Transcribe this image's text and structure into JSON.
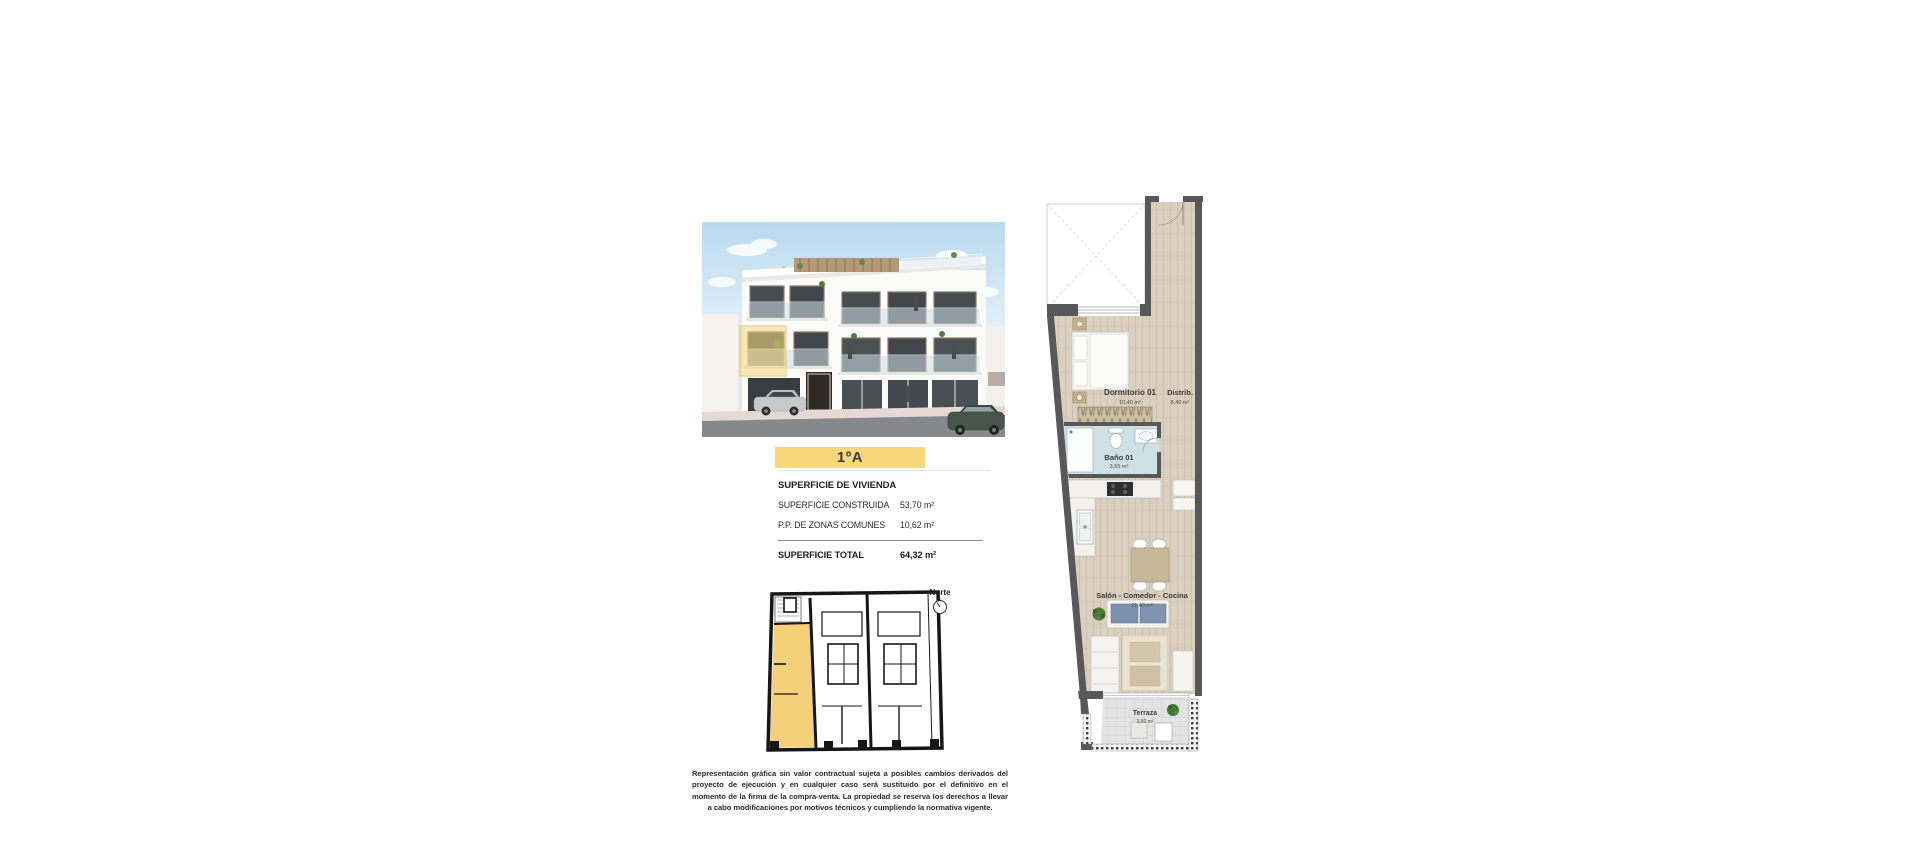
{
  "unit": {
    "title": "1ºA"
  },
  "surface_table": {
    "header": "SUPERFICIE DE VIVIENDA",
    "rows": [
      {
        "label": "SUPERFICIE CONSTRUIDA",
        "value": "53,70 m²"
      },
      {
        "label": "P.P. DE ZONAS COMUNES",
        "value": "10,62 m²"
      }
    ],
    "total_label": "SUPERFICIE TOTAL",
    "total_value": "64,32 m²"
  },
  "floor_plan": {
    "rooms": [
      {
        "name": "Dormitorio 01",
        "area": "10,40 m²"
      },
      {
        "name": "Distrib.",
        "area": "8,40 m²"
      },
      {
        "name": "Baño 01",
        "area": "3,55 m²"
      },
      {
        "name": "Salón - Comedor - Cocina",
        "area": "21,40 m²"
      },
      {
        "name": "Terraza",
        "area": "3,60 m²"
      }
    ]
  },
  "key_plan": {
    "north_label": "Norte"
  },
  "disclaimer": "Representación gráfica sin valor contractual sujeta a posibles cambios derivados del proyecto de ejecución y en cualquier caso será sustituido por el definitivo en el momento de la firma de la compra-venta. La propiedad se reserva los derechos a llevar a cabo modificaciones por motivos técnicos y cumpliendo la normativa vigente.",
  "colors": {
    "accent_yellow": "#f8d77b",
    "keyplan_highlight": "#f5d07a",
    "plan_wall": "#58585a",
    "plan_wood": "#dbcfbf",
    "plan_bath": "#cfe0e5",
    "sky_blue": "#bfdcef"
  }
}
